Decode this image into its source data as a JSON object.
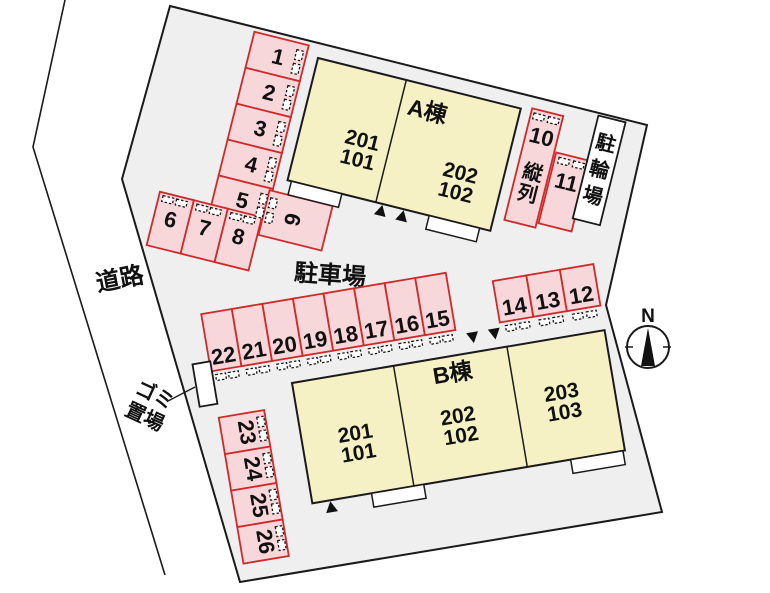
{
  "site": {
    "road_label": "道路",
    "parking_lot_label": "駐車場",
    "garbage_area": {
      "line1": "ゴミ",
      "line2": "置場"
    },
    "bicycle_parking": {
      "label": "駐輪場",
      "chars": [
        "駐",
        "輪",
        "場"
      ]
    },
    "tandem": {
      "label": "縦列",
      "chars": [
        "縦",
        "列"
      ]
    },
    "compass_north": "N",
    "colors": {
      "site_fill": "#efefef",
      "building_fill": "#f6f1c5",
      "parking_fill": "#f8d7da",
      "parking_border": "#ce2a2a",
      "outline": "#1a1a1a"
    }
  },
  "buildings": {
    "a": {
      "name": "A棟",
      "units": [
        {
          "upper": "201",
          "lower": "101"
        },
        {
          "upper": "202",
          "lower": "102"
        }
      ]
    },
    "b": {
      "name": "B棟",
      "units": [
        {
          "upper": "201",
          "lower": "101"
        },
        {
          "upper": "202",
          "lower": "102"
        },
        {
          "upper": "203",
          "lower": "103"
        }
      ]
    }
  },
  "parking": {
    "col_1_5": [
      "1",
      "2",
      "3",
      "4",
      "5"
    ],
    "row_6_8": [
      "6",
      "7",
      "8"
    ],
    "space_9": "9",
    "space_10": "10",
    "space_11": "11",
    "row_22_15": [
      "22",
      "21",
      "20",
      "19",
      "18",
      "17",
      "16",
      "15"
    ],
    "row_14_12": [
      "14",
      "13",
      "12"
    ],
    "col_23_26": [
      "23",
      "24",
      "25",
      "26"
    ]
  }
}
